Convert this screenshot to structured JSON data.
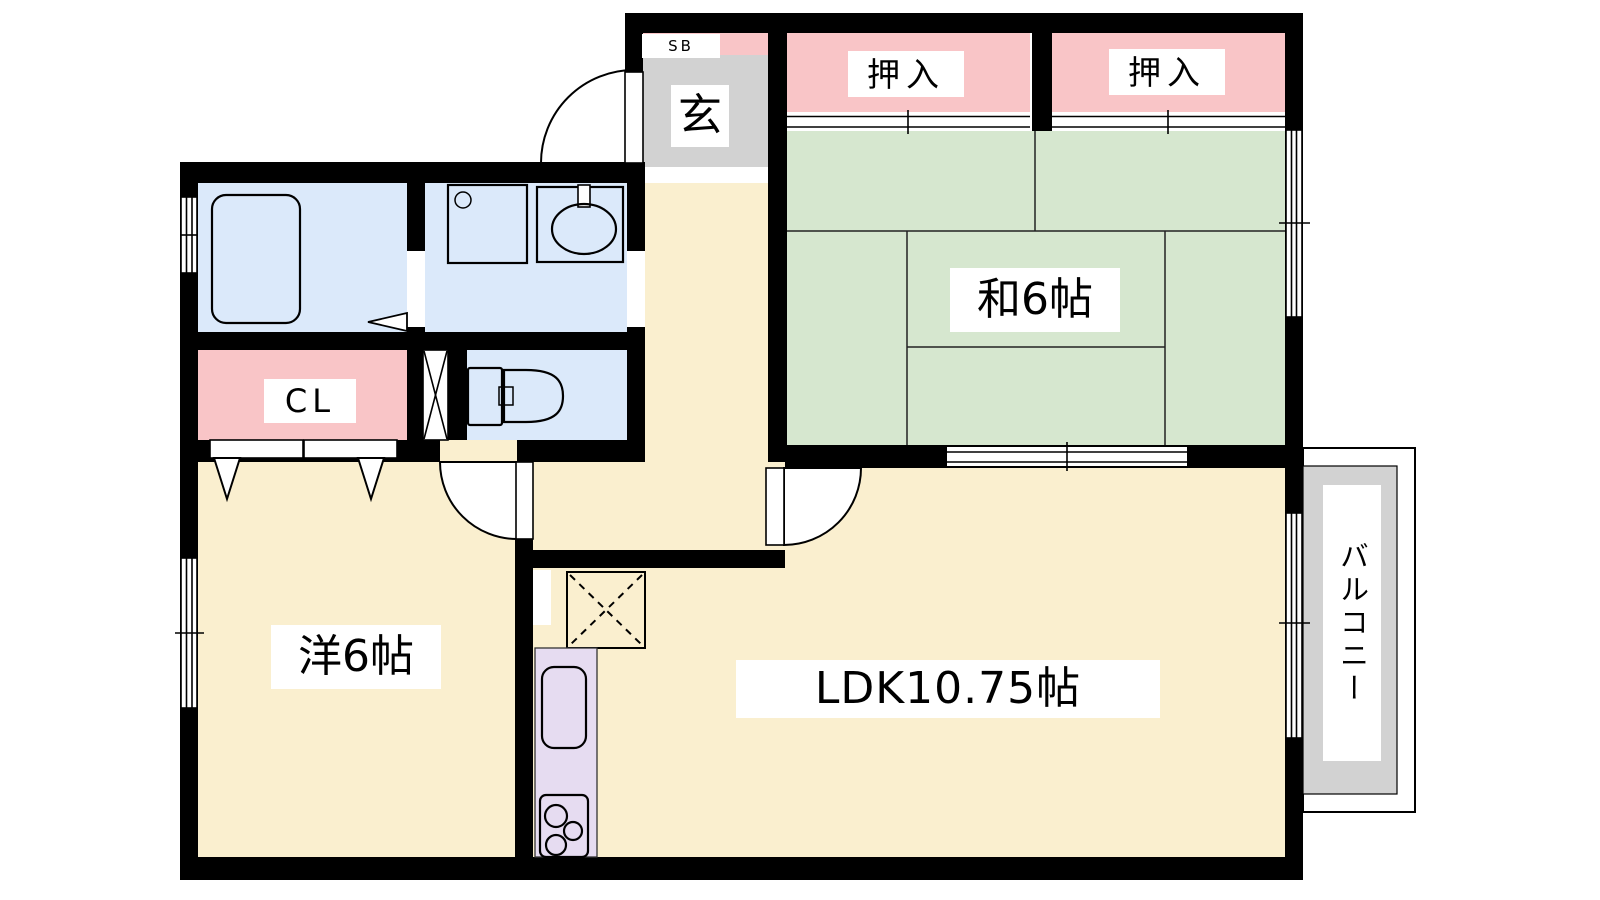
{
  "document": {
    "type": "apartment-floor-plan"
  },
  "palette": {
    "wall": "#000000",
    "floor": "#FAEFCF",
    "tatami": "#D6E7CF",
    "closet": "#F9C5C7",
    "sanitary": "#DBE9FA",
    "kitchen": "#E6DCF1",
    "entrance": "#D2D2D2",
    "balcony": "#D2D2D2"
  },
  "labels": {
    "shoe_box": "SB",
    "entrance": "玄",
    "closet_upper_1": "押入",
    "closet_upper_2": "押入",
    "japanese_room": "和6帖",
    "closet_cl": "CL",
    "western_room": "洋6帖",
    "ldk": "LDK10.75帖",
    "balcony": "バルコニー"
  }
}
